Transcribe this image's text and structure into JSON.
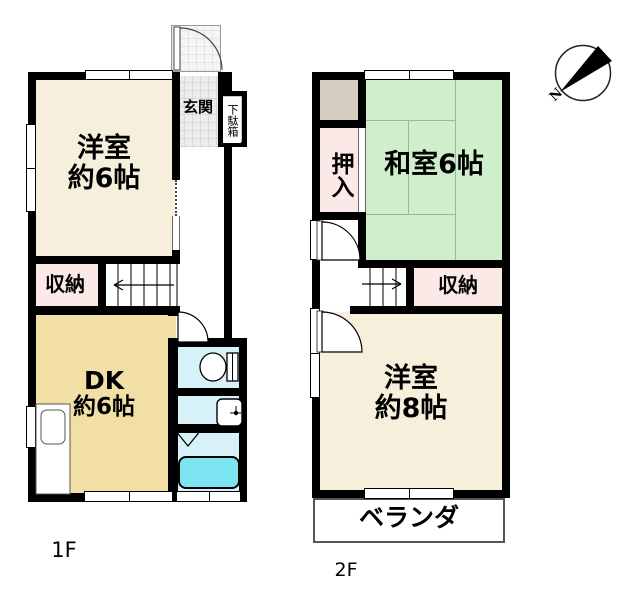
{
  "colors": {
    "wall": "#000000",
    "western_room": "#f6efdb",
    "dk": "#f1dfa6",
    "closet_pink": "#fbe9e8",
    "tatami_green": "#cfeecb",
    "sanitary_cyan": "#d7f1f8",
    "bathtub_cyan": "#7de5f1",
    "wood_beige": "#d6cec0",
    "entrance_tile": "#ececec"
  },
  "floor1": {
    "name": "1F",
    "western_room_line1": "洋室",
    "western_room_line2": "約6帖",
    "entrance": "玄関",
    "shoe_cabinet": "下駄箱",
    "storage": "収納",
    "dk_line1": "DK",
    "dk_line2": "約6帖"
  },
  "floor2": {
    "name": "2F",
    "closet": "押入",
    "japanese_room": "和室6帖",
    "storage": "収納",
    "western_room_line1": "洋室",
    "western_room_line2": "約8帖",
    "veranda": "ベランダ"
  },
  "compass": {
    "north": "N"
  }
}
